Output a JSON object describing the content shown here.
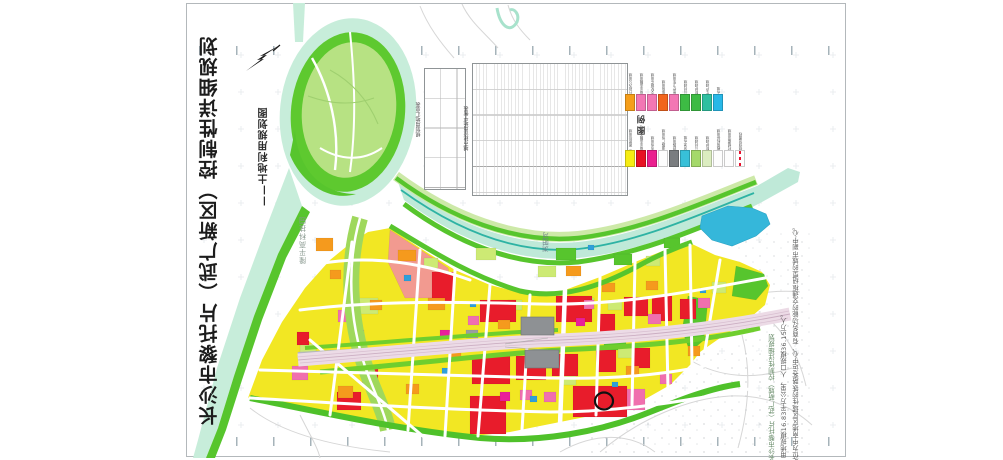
{
  "title_block": {
    "title": "长沙市黎托片（武广新区）控制性详细规划",
    "subtitle": "——土地利用规划图"
  },
  "compass": {
    "icon": "north-arrow"
  },
  "tables": {
    "summary": {
      "title": "规划用地汇总表"
    },
    "balance": {
      "title": "城市建设用地平衡表"
    }
  },
  "legend": {
    "title": "图 例",
    "row1": [
      {
        "label": "行政办公用地",
        "color": "#f59e1a"
      },
      {
        "label": "商业金融用地",
        "color": "#f377b4"
      },
      {
        "label": "文化娱乐用地",
        "color": "#f377b4"
      },
      {
        "label": "体育用地",
        "color": "#f2641c"
      },
      {
        "label": "医疗卫生用地",
        "color": "#f377b4"
      },
      {
        "label": "公共绿地",
        "color": "#3dbb44"
      },
      {
        "label": "防护绿地",
        "color": "#3dbb44"
      },
      {
        "label": "生产绿地",
        "color": "#2fbfa0"
      },
      {
        "label": "水域",
        "color": "#28b8e8"
      }
    ],
    "row2": [
      {
        "label": "二类居住用地",
        "color": "#f6ec13"
      },
      {
        "label": "商业金融业用地",
        "color": "#e81123"
      },
      {
        "label": "市场用地",
        "color": "#ea1f8e"
      },
      {
        "label": "道路广场用地",
        "color": "#fdfdfd"
      },
      {
        "label": "铁路用地",
        "color": "#7a7d80"
      },
      {
        "label": "河流水域",
        "color": "#38c0d8"
      },
      {
        "label": "公共绿地",
        "color": "#a5d96a"
      },
      {
        "label": "防护绿地",
        "color": "#dcedc0"
      },
      {
        "label": "教育科研用地",
        "color": "#fdfdfd"
      },
      {
        "label": "村镇建设用地",
        "color": "#fdfdfd"
      },
      {
        "label": "规划范围线",
        "color": "#ffffff",
        "dash": true
      }
    ]
  },
  "map": {
    "labels": {
      "park": "隆平高科技园",
      "river": "浏阳河"
    },
    "colors": {
      "residential_yellow": "#f2e723",
      "commercial_red": "#e81c2b",
      "public_pink": "#f06fae",
      "mixed_orange": "#f59a1d",
      "salmon": "#f29a90",
      "green_space": "#57c52d",
      "light_green": "#cdea74",
      "river": "#bfe9d8",
      "river_line": "#2eb3a4",
      "lake_blue": "#35b7da",
      "railway_band": "#ecdbe6",
      "station_gray": "#8e9194"
    }
  },
  "annotation": {
    "bullet": "■",
    "line1": "长沙市黎托片（武广新城）控制性详细规划",
    "line2": "用地规模16.83平方公里，人口规模36.15万人。",
    "line3": "定位为中南地区区域性的铁路客运中心、有商务功能的交通枢纽型的城市副中心。"
  }
}
